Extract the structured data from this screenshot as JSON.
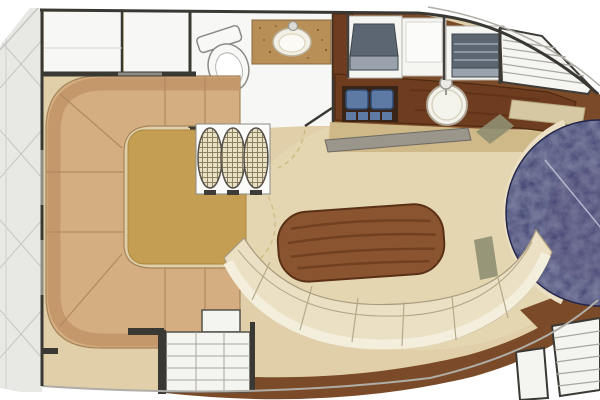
{
  "image": {
    "kind": "yacht-interior-floorplan-illustration",
    "width": 600,
    "height": 400
  },
  "regions": {
    "side_deck": {
      "name": "side deck (hatched walkway)"
    },
    "forward_cabins": {
      "name": "forward compartments"
    },
    "head": {
      "name": "head / bathroom",
      "fixtures": [
        "toilet",
        "vanity-counter",
        "oval-sink",
        "door-swing-arc"
      ]
    },
    "galley": {
      "name": "galley",
      "fixtures": [
        "two-burner-stove",
        "round-sink",
        "faucet",
        "refrigerator",
        "appliance",
        "wood-counter"
      ]
    },
    "saloon": {
      "name": "main saloon",
      "fixtures": [
        "u-shaped-settee",
        "gold-rug",
        "stowed-wicker-chairs",
        "oval-wood-table",
        "curved-bench"
      ]
    },
    "companionways": {
      "name": "stairs and steps",
      "fixtures": [
        "deck-stairs",
        "aft-steps",
        "side-steps"
      ]
    },
    "round_berth": {
      "name": "navy circular element (partially visible at right edge)"
    }
  },
  "colors": {
    "white": "#ffffff",
    "outline_dark": "#3a3833",
    "outline_gray": "#b0ada6",
    "deck_gray": "#e8e8e5",
    "deck_hatch": "#c6c6c2",
    "wall_window": "#8f8c86",
    "floor_tan": "#e0cfa8",
    "floor_tan_light": "#e9dcba",
    "khaki_strip": "#cfb989",
    "step_gray": "#9b968c",
    "wood_floor": "#7b4a28",
    "wood_dark": "#5a3116",
    "settee_base": "#d4ae80",
    "settee_back": "#c5986c",
    "settee_line": "#b08a60",
    "rug_gold": "#c49e52",
    "table_wood": "#8a5430",
    "table_grain": "#6a3c1e",
    "bench_cream": "#ebdfc4",
    "bench_back": "#f4eedd",
    "bench_line": "#b3a687",
    "room_white": "#f7f7f5",
    "cabinet_white": "#f5f5f2",
    "counter_tan": "#b98f58",
    "counter_dot": "#8a6436",
    "sink_white": "#f4f3ec",
    "sink_ring": "#c9c2ae",
    "galley_counter": "#6e3d20",
    "stove_panel": "#3a2418",
    "burner_blue": "#5d7aa4",
    "appliance_dark": "#5c6672",
    "appliance_light": "#9aa3ad",
    "stairs_line": "#a9a69e",
    "mat_khaki": "#d5c8a2",
    "olive": "#8f8f72",
    "navy_base": "#343a5e",
    "navy_dark": "#20244a",
    "navy_seam": "#c9cdde",
    "dashed_arc": "#cdbd82",
    "wicker_bg": "#e9e1c4",
    "wicker_line": "#8d8164",
    "fixture_outline": "#8a8a86"
  }
}
